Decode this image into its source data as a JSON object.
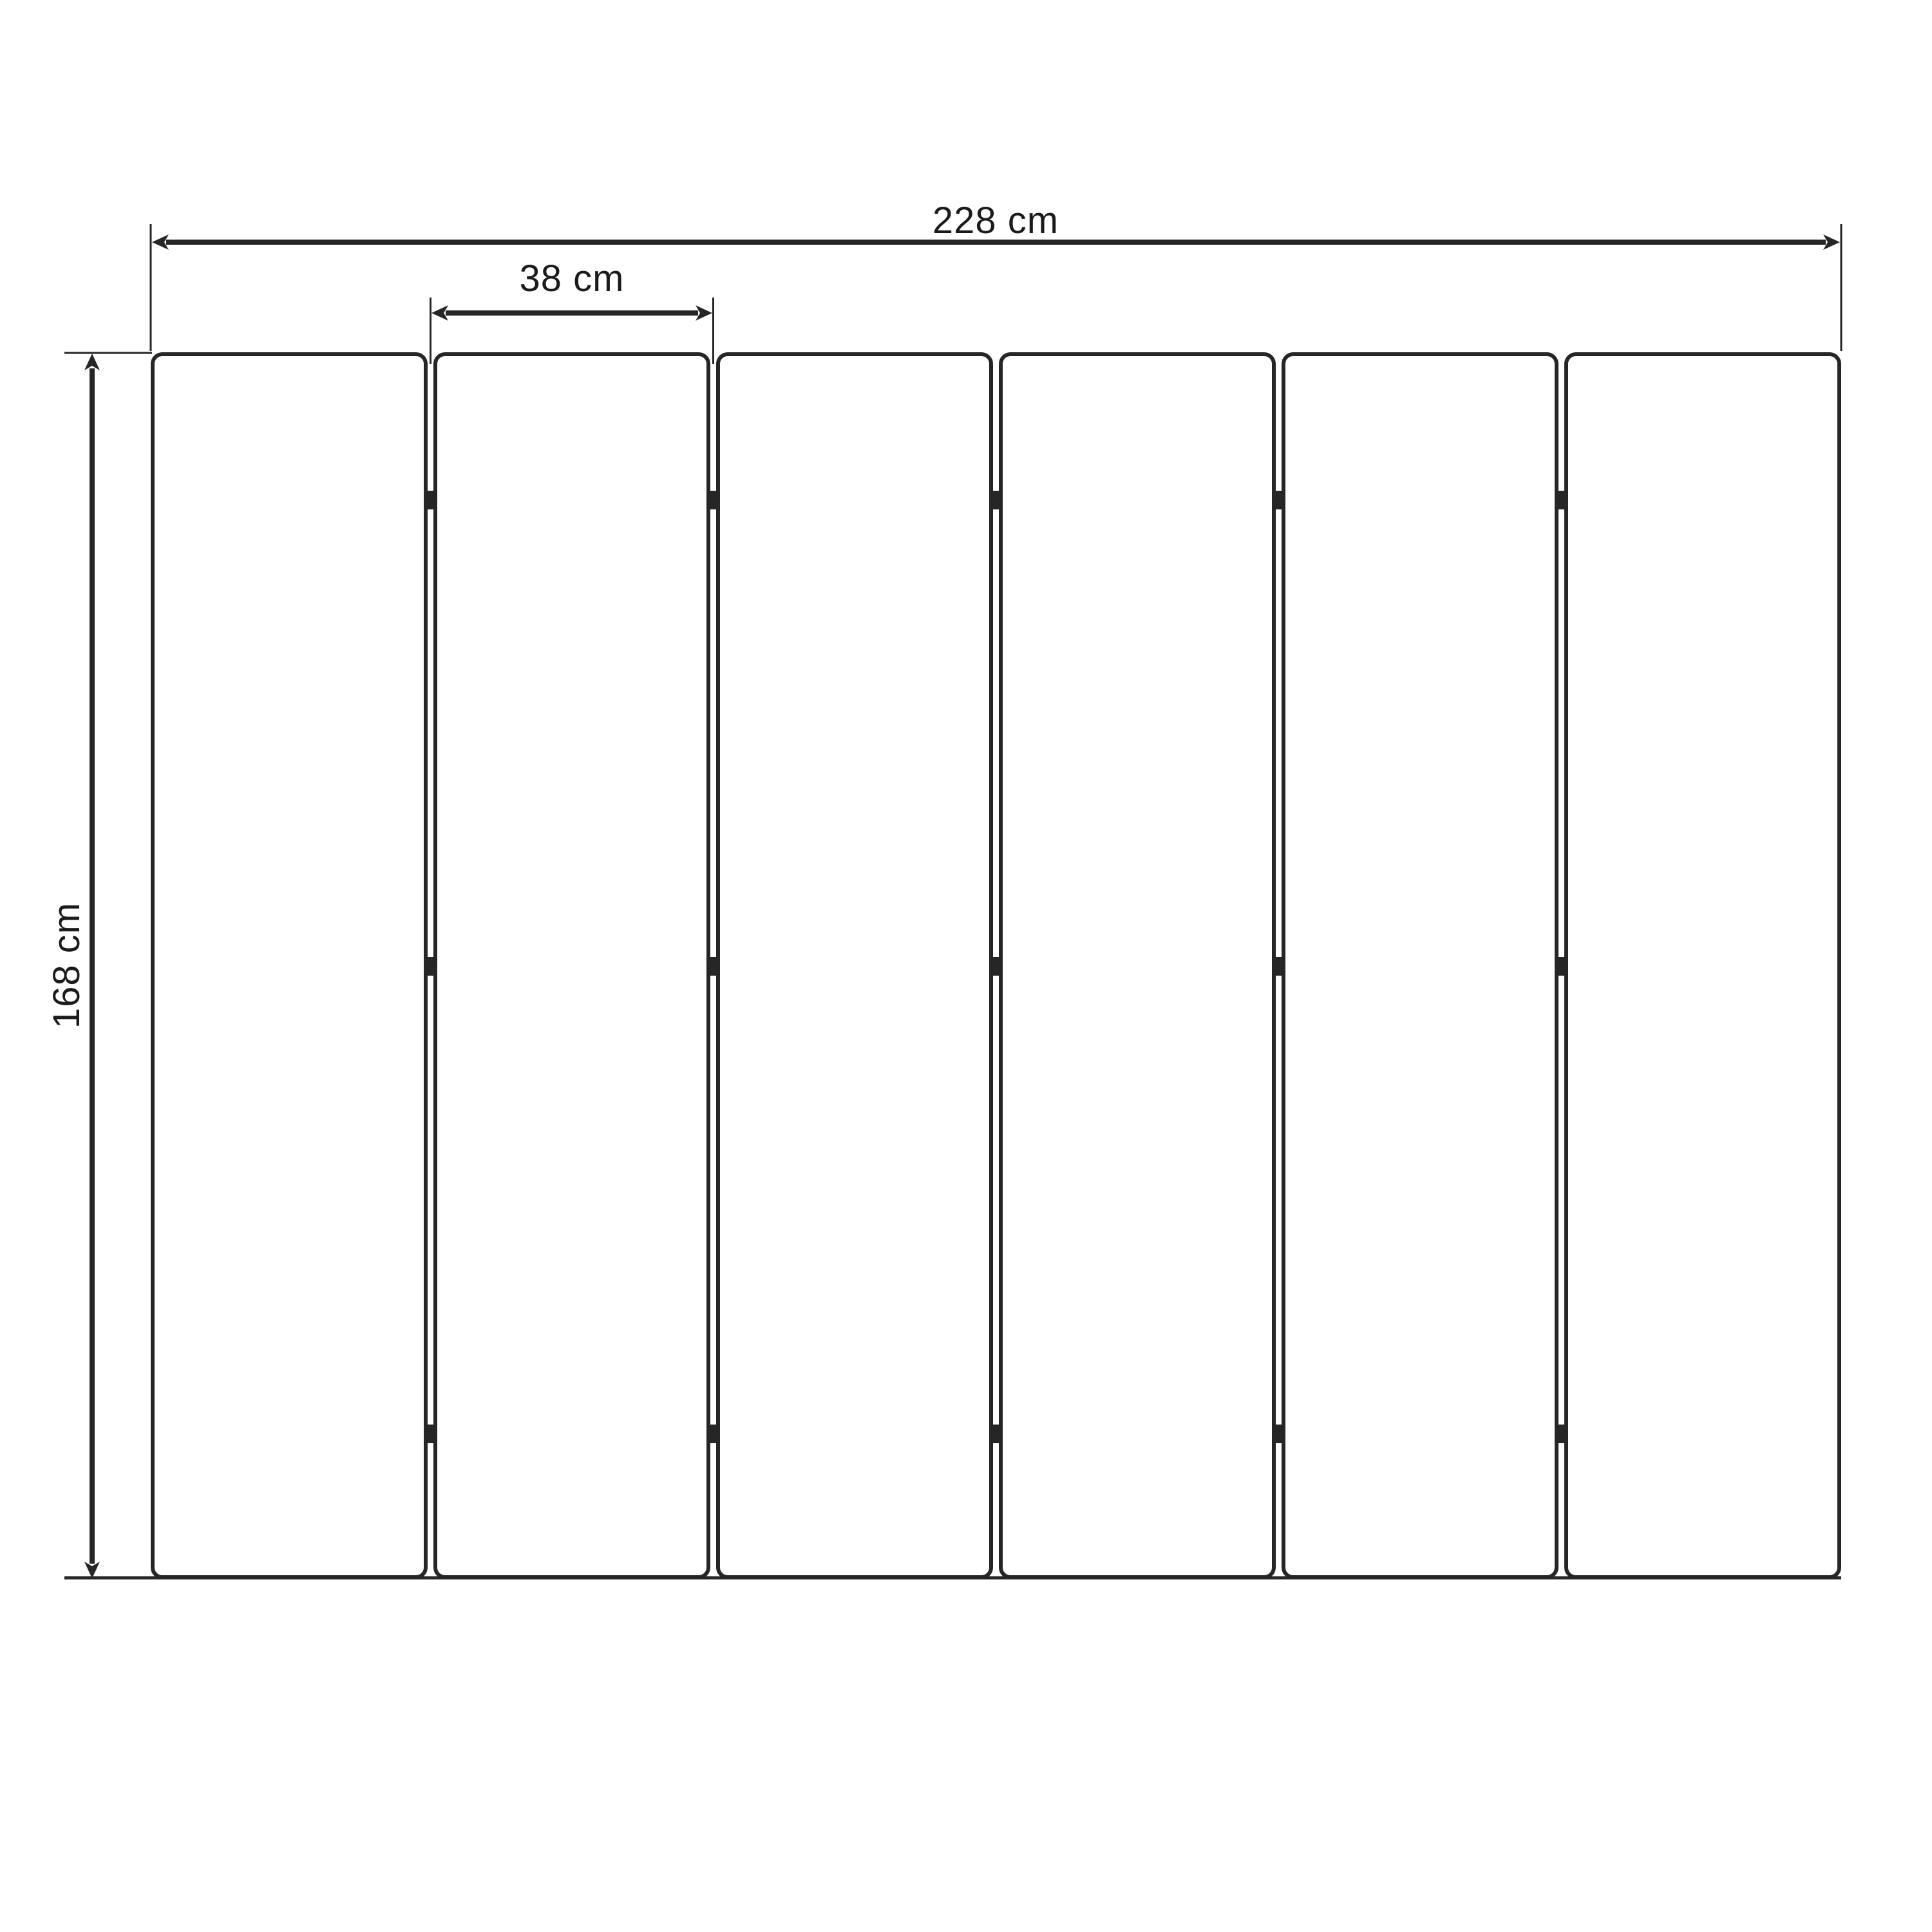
{
  "diagram": {
    "title": "panel-screen-dimension-drawing",
    "labels": {
      "total_width": "228 cm",
      "panel_width": "38 cm",
      "height": "168 cm"
    },
    "panel_count": 6,
    "gap_count": 5,
    "hinges_per_gap": 3,
    "colors": {
      "line": "#262626",
      "text": "#1b1b1b",
      "background": "#ffffff"
    }
  }
}
